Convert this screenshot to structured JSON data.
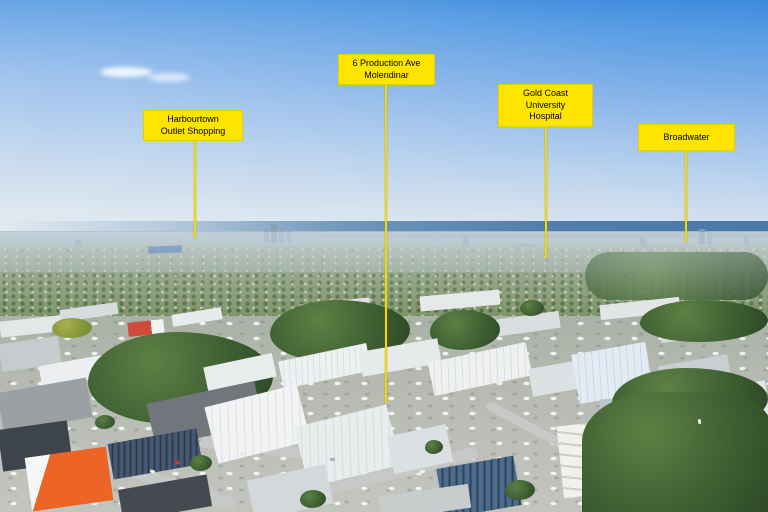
{
  "scene": {
    "description": "Aerial drone photograph of an industrial suburb with distant city skyline, ocean horizon and four yellow location callouts"
  },
  "callouts": [
    {
      "id": "harbourtown-outlet-shopping",
      "label": "Harbourtown\nOutlet Shopping"
    },
    {
      "id": "6-production-ave-molendinar",
      "label": "6 Production Ave\nMolendinar"
    },
    {
      "id": "gold-coast-university-hospital",
      "label": "Gold Coast University\nHospital"
    },
    {
      "id": "broadwater",
      "label": "Broadwater"
    }
  ],
  "colors": {
    "callout_bg": "#FFE400",
    "callout_text": "#000000",
    "leader_line": "#F2D800",
    "sky_top": "#3D89DC",
    "ocean": "#4A7AAA",
    "orange_building": "#EC6527"
  }
}
